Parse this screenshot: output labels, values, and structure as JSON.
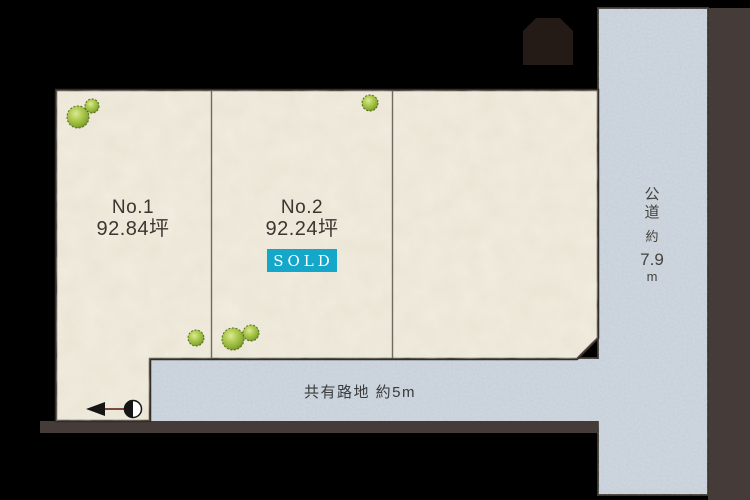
{
  "diagram_type": "land-plot-map",
  "plots": [
    {
      "number": "No.1",
      "area": "92.84坪",
      "status": ""
    },
    {
      "number": "No.2",
      "area": "92.24坪",
      "status": "SOLD"
    },
    {
      "number": "",
      "area": "",
      "status": ""
    }
  ],
  "roads": {
    "public_road": {
      "full_label": "公道 約7.9m",
      "name_chars": [
        "公",
        "道"
      ],
      "approx": "約",
      "width": "7.9",
      "unit": "m"
    },
    "shared_alley": {
      "label": "共有路地 約5m"
    }
  },
  "colors": {
    "background": "#000000",
    "plot_fill": "#e9e4d3",
    "road_fill": "#c5ced8",
    "boundary_strip": "#453b39",
    "plot_outline": "#332d28",
    "divider_line": "#6f695f",
    "sold_badge_bg": "#14a7c9",
    "sold_badge_text": "#ffffff",
    "building_fill": "#241a16",
    "tree_green": "#8aab33",
    "label_text": "#3b3530"
  },
  "icons": {
    "north_arrow": "north-arrow",
    "tree": "bush-tree",
    "building": "neighbor-building"
  }
}
